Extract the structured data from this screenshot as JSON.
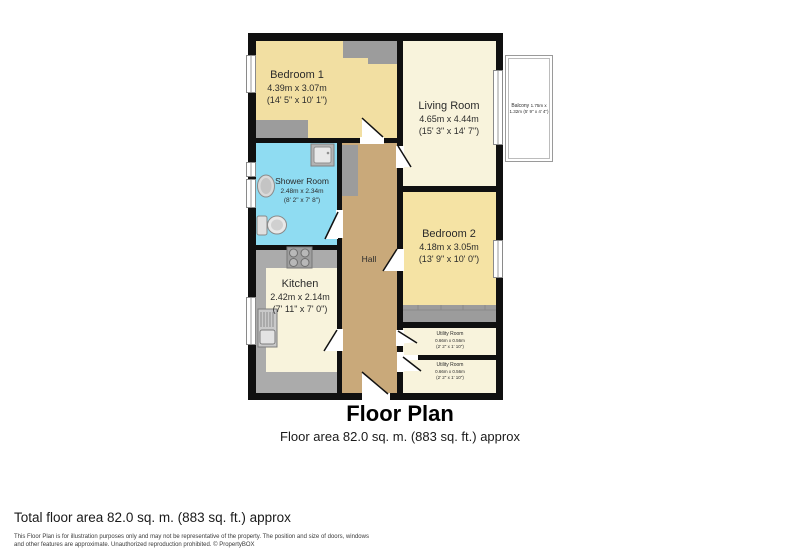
{
  "title": {
    "heading": "Floor Plan",
    "subheading": "Floor area 82.0 sq. m. (883 sq. ft.) approx"
  },
  "footer": {
    "total": "Total floor area 82.0 sq. m. (883 sq. ft.) approx",
    "disclaimer_line1": "This Floor Plan is for illustration purposes only and may not be representative of the property. The position and size of doors, windows",
    "disclaimer_line2": "and other features are approximate. Unauthorized reproduction prohibited. © PropertyBOX"
  },
  "rooms": {
    "bedroom1": {
      "name": "Bedroom 1",
      "metric": "4.39m x 3.07m",
      "imperial": "(14' 5\" x 10' 1\")"
    },
    "living": {
      "name": "Living Room",
      "metric": "4.65m x 4.44m",
      "imperial": "(15' 3\" x 14' 7\")"
    },
    "shower": {
      "name": "Shower Room",
      "metric": "2.48m x 2.34m",
      "imperial": "(8' 2\" x 7' 8\")"
    },
    "kitchen": {
      "name": "Kitchen",
      "metric": "2.42m x 2.14m",
      "imperial": "(7' 11\" x 7' 0\")"
    },
    "hall": {
      "name": "Hall"
    },
    "bedroom2": {
      "name": "Bedroom 2",
      "metric": "4.18m x 3.05m",
      "imperial": "(13' 9\" x 10' 0\")"
    },
    "utility1": {
      "name": "Utility Room",
      "metric": "0.66m x 0.56m",
      "imperial": "(2' 2\" x 1' 10\")"
    },
    "utility2": {
      "name": "Utility Room",
      "metric": "0.66m x 0.56m",
      "imperial": "(2' 2\" x 1' 10\")"
    },
    "balcony": {
      "name": "Balcony",
      "metric": "1.75m x 1.32m",
      "imperial": "(5' 9\" x 4' 4\")"
    }
  },
  "colors": {
    "wall": "#101010",
    "bedroom_fill": "#F2DFA2",
    "cream_fill": "#F8F3DC",
    "shower_fill": "#8FDCF2",
    "hall_fill": "#C9A97A",
    "counter_gray": "#ABABAB",
    "wardrobe_gray": "#9C9C9C"
  }
}
